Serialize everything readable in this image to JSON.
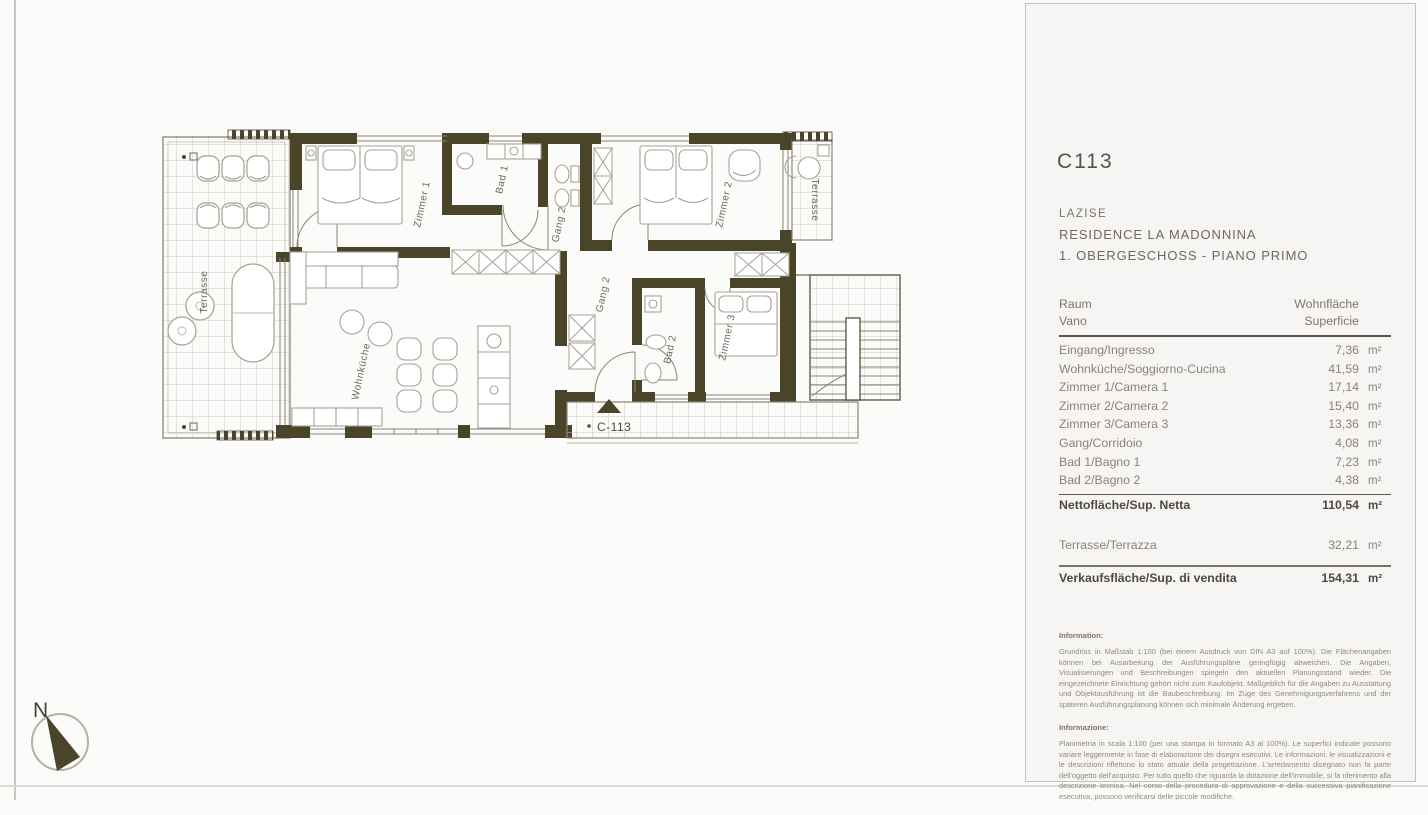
{
  "page": {
    "code": "C113",
    "location": "LAZISE",
    "residence": "RESIDENCE LA MADONNINA",
    "floor": "1. OBERGESCHOSS - PIANO PRIMO"
  },
  "table": {
    "header": {
      "room_de": "Raum",
      "room_it": "Vano",
      "area_de": "Wohnfläche",
      "area_it": "Superficie"
    },
    "unit": "m²",
    "rows": [
      {
        "label": "Eingang/Ingresso",
        "value": "7,36"
      },
      {
        "label": "Wohnküche/Soggiorno-Cucina",
        "value": "41,59"
      },
      {
        "label": "Zimmer 1/Camera 1",
        "value": "17,14"
      },
      {
        "label": "Zimmer 2/Camera 2",
        "value": "15,40"
      },
      {
        "label": "Zimmer 3/Camera 3",
        "value": "13,36"
      },
      {
        "label": "Gang/Corridoio",
        "value": "4,08"
      },
      {
        "label": "Bad 1/Bagno 1",
        "value": "7,23"
      },
      {
        "label": "Bad 2/Bagno 2",
        "value": "4,38"
      }
    ],
    "net": {
      "label": "Nettofläche/Sup. Netta",
      "value": "110,54"
    },
    "terrace": {
      "label": "Terrasse/Terrazza",
      "value": "32,21"
    },
    "total": {
      "label": "Verkaufsfläche/Sup. di vendita",
      "value": "154,31"
    }
  },
  "info": {
    "de_title": "Information:",
    "de_text": "Grundriss in Maßstab 1:100 (bei einem Ausdruck von DIN A3 auf 100%). Die Flächenangaben können bei Ausarbeitung der Ausführungspläne geringfügig abweichen. Die Angaben, Visualisierungen und Beschreibungen spiegeln den aktuellen Planungsstand wieder. Die eingezeichnete Einrichtung gehört nicht zum Kaufobjekt. Maßgeblich für die Angaben zu Ausstattung und Objektausführung ist die Baubeschreibung. Im Zuge des Genehmigungsverfahrens und der späteren Ausführungsplanung können sich minimale Änderung ergeben.",
    "it_title": "Informazione:",
    "it_text": "Planimetria in scala 1:100 (per una stampa in formato A3 al 100%). Le superfici indicate possono variare leggermente in fase di elaborazione dei disegni esecutivi. Le informazioni, le visualizzazioni e le descrizioni riflettono lo stato attuale della progettazione. L'arredamento disegnato non fa parte dell'oggetto dell'acquisto. Per tutto quello che riguarda la dotazione dell'immobile, si fa riferimento alla descrizione tecnica. Nel corso della procedura di approvazione e della successiva pianificazione esecutiva, possono verificarsi delle piccole modifiche."
  },
  "plan": {
    "labels": {
      "terrace_left": "Terrasse",
      "zimmer1": "Zimmer 1",
      "bad1": "Bad 1",
      "gang2_upper": "Gang 2",
      "zimmer2": "Zimmer 2",
      "terrace_right": "Terrasse",
      "gang2_lower": "Gang 2",
      "wohnkueche": "Wohnküche",
      "bad2": "Bad 2",
      "zimmer3": "Zimmer 3",
      "unit_marker": "C-113",
      "north": "N"
    },
    "colors": {
      "wall": "#4a4429",
      "line": "#8b8577",
      "furniture": "#a7a193",
      "grid": "#cdc9bd"
    }
  }
}
